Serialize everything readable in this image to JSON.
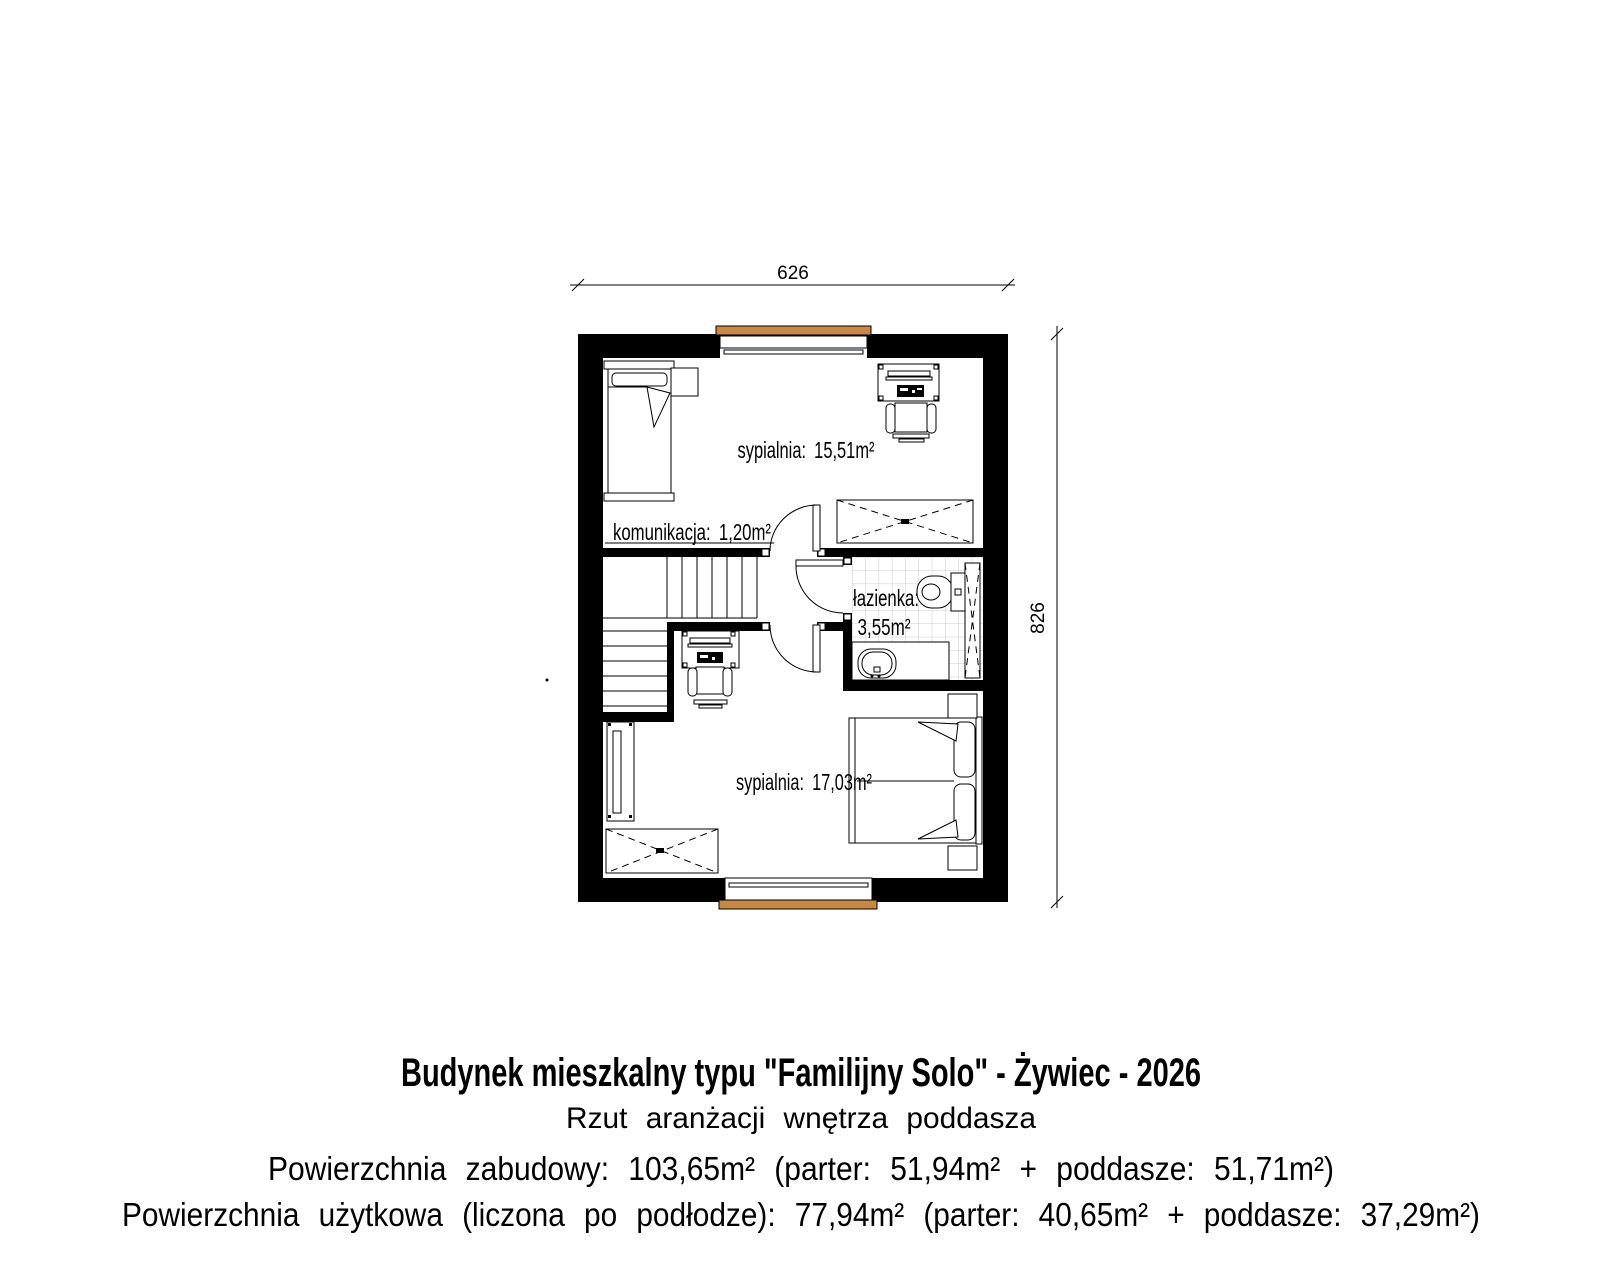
{
  "page": {
    "background": "#ffffff"
  },
  "colors": {
    "wall": "#000000",
    "window_frame": "#c9873f",
    "tile_grid": "#cccccc",
    "line": "#000000"
  },
  "dimensions": {
    "top": "626",
    "right": "826"
  },
  "rooms": {
    "bedroom_top": {
      "label": "sypialnia: 15,51m²"
    },
    "corridor": {
      "label": "komunikacja: 1,20m²"
    },
    "bathroom": {
      "name": "łazienka:",
      "area": "3,55m²"
    },
    "bedroom_bottom": {
      "label": "sypialnia: 17,03m²"
    }
  },
  "furniture_symbols": [
    "single-bed",
    "double-bed",
    "desk",
    "office-chair",
    "wardrobe",
    "stairs",
    "door",
    "toilet",
    "washbasin-vanity",
    "shower",
    "nightstand",
    "dresser-panel",
    "window",
    "side-table"
  ],
  "title_block": {
    "title": "Budynek mieszkalny typu \"Familijny Solo\" - Żywiec - 2026",
    "subtitle": "Rzut aranżacji wnętrza poddasza",
    "area_built": "Powierzchnia zabudowy: 103,65m² (parter: 51,94m² + poddasze: 51,71m²)",
    "area_usable": "Powierzchnia użytkowa (liczona po podłodze): 77,94m² (parter: 40,65m² + poddasze: 37,29m²)"
  }
}
